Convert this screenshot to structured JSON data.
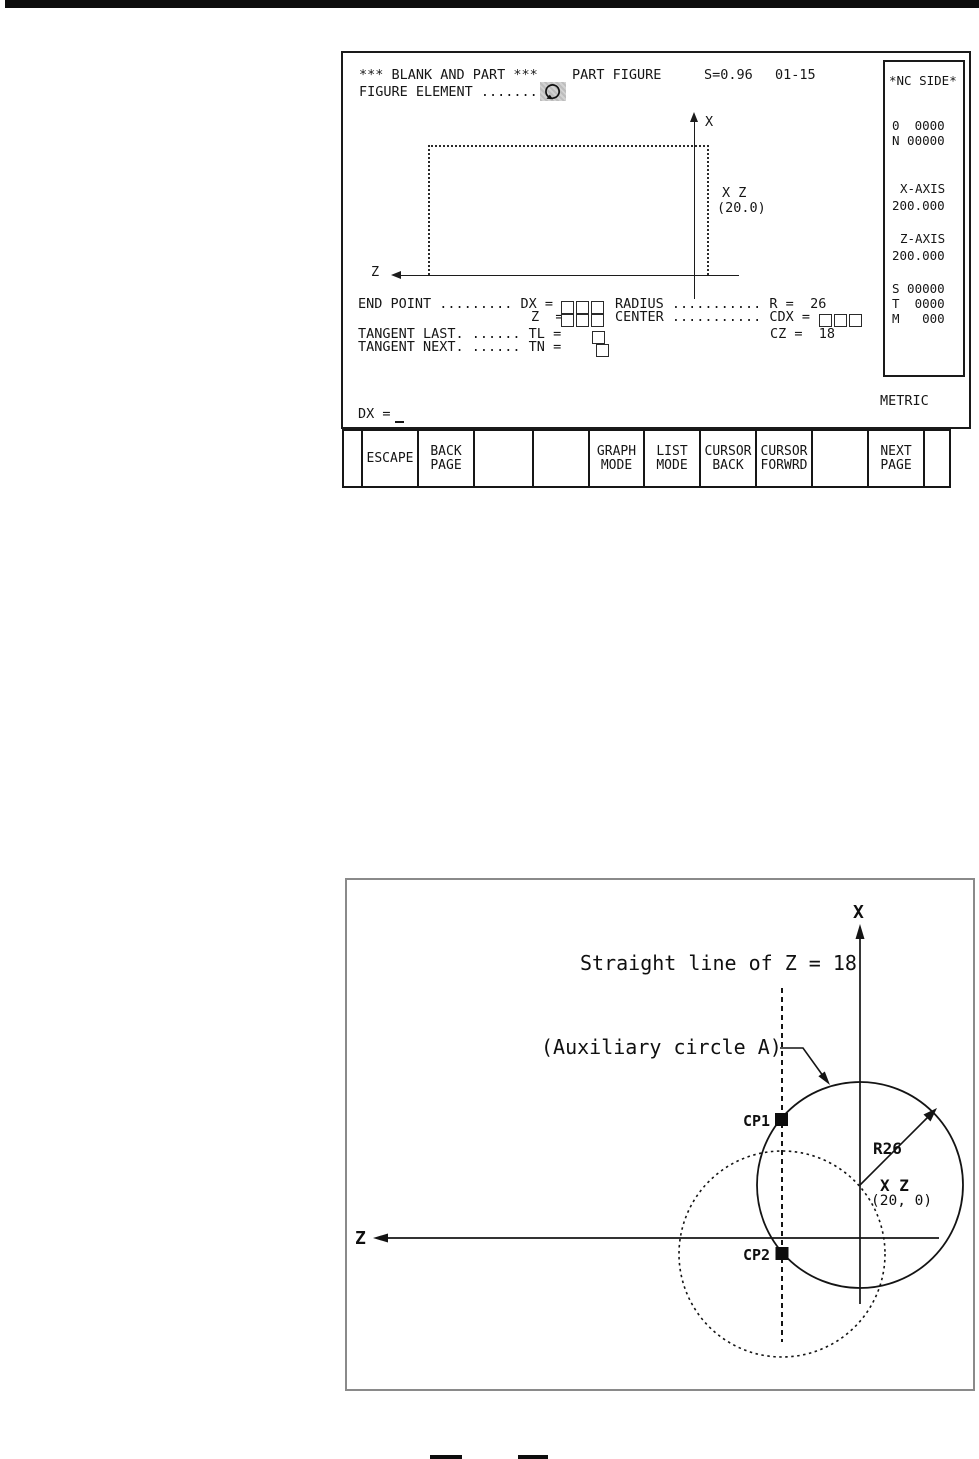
{
  "nc_screen": {
    "title": {
      "left": "*** BLANK AND PART ***",
      "mid": "PART FIGURE",
      "scale": "S=0.96",
      "page": "01-15"
    },
    "figure_element_line": "FIGURE ELEMENT ........",
    "figure": {
      "x_axis": "X",
      "z_axis": "Z",
      "point": "X Z",
      "point_value": "(20.0)"
    },
    "fields": {
      "end_point_left": "END POINT ......... DX =",
      "radius_right": "RADIUS ........... R =  26",
      "z_left": "Z  =",
      "center_right": "CENTER ........... CDX =",
      "tangent_last": "TANGENT LAST. ...... TL =",
      "cz_value": "CZ =  18",
      "tangent_next": "TANGENT NEXT. ...... TN ="
    },
    "prompt_label": "DX =",
    "unit": "METRIC",
    "nc_side": {
      "title": "*NC SIDE*",
      "rows": [
        "0  0000",
        "N 00000",
        "X-AXIS",
        "200.000",
        "Z-AXIS",
        "200.000",
        "S 00000",
        "T  0000",
        "M   000"
      ]
    },
    "softkeys": [
      {
        "l1": "",
        "l2": ""
      },
      {
        "l1": "ESCAPE",
        "l2": ""
      },
      {
        "l1": "BACK",
        "l2": "PAGE"
      },
      {
        "l1": "",
        "l2": ""
      },
      {
        "l1": "",
        "l2": ""
      },
      {
        "l1": "GRAPH",
        "l2": "MODE"
      },
      {
        "l1": "LIST",
        "l2": "MODE"
      },
      {
        "l1": "CURSOR",
        "l2": "BACK"
      },
      {
        "l1": "CURSOR",
        "l2": "FORWRD"
      },
      {
        "l1": "",
        "l2": ""
      },
      {
        "l1": "NEXT",
        "l2": "PAGE"
      },
      {
        "l1": "",
        "l2": ""
      }
    ]
  },
  "diagram": {
    "x_axis": "X",
    "z_axis": "Z",
    "straight_line_label": "Straight line of Z = 18",
    "aux_circle_label": "(Auxiliary circle A)",
    "cp1": "CP1",
    "cp2": "CP2",
    "radius": "R26",
    "center_point": "X Z",
    "center_value": "(20, 0)"
  }
}
